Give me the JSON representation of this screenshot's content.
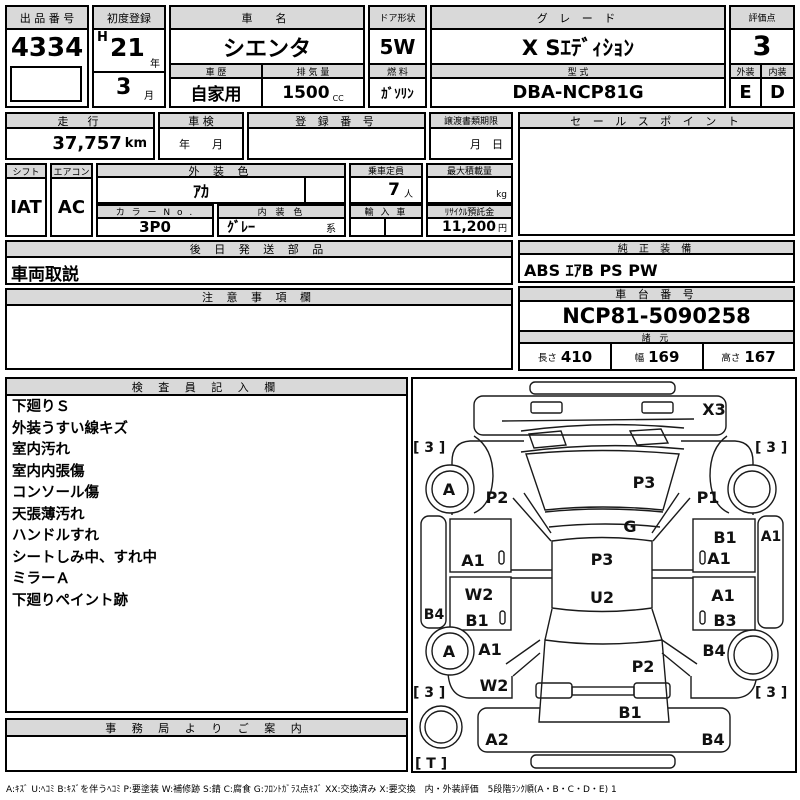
{
  "top": {
    "auction_no": {
      "label": "出 品 番 号",
      "value": "4334"
    },
    "first_reg": {
      "label": "初度登録",
      "era": "H",
      "year": "21",
      "year_unit": "年",
      "month": "3",
      "month_unit": "月"
    },
    "car_name": {
      "label": "車　名",
      "value": "シエンタ"
    },
    "history": {
      "label": "車 歴",
      "value": "自家用"
    },
    "displacement": {
      "label": "排 気 量",
      "value": "1500",
      "unit": "CC"
    },
    "door": {
      "label": "ドア形状",
      "value": "5W"
    },
    "fuel": {
      "label": "燃 料",
      "value": "ｶﾞｿﾘﾝ"
    },
    "grade": {
      "label": "グ レ ー ド",
      "value": "X Sｴﾃﾞｨｼｮﾝ"
    },
    "model": {
      "label": "型 式",
      "value": "DBA-NCP81G"
    },
    "score": {
      "label": "評価点",
      "value": "3"
    },
    "exterior": {
      "label": "外装",
      "value": "E"
    },
    "interior": {
      "label": "内装",
      "value": "D"
    }
  },
  "info": {
    "mileage": {
      "label": "走　行",
      "value": "37,757",
      "unit": "km"
    },
    "shaken": {
      "label": "車 検",
      "value": "年　　月"
    },
    "regno": {
      "label": "登 録 番 号",
      "value": ""
    },
    "deadline": {
      "label": "譲渡書類期限",
      "value": "月　日"
    },
    "shift": {
      "label": "シフト",
      "value": "IAT"
    },
    "aircon": {
      "label": "エアコン",
      "value": "AC"
    },
    "ext_color": {
      "label": "外 装 色",
      "value": "ｱｶ"
    },
    "capacity": {
      "label": "乗車定員",
      "value": "7",
      "unit": "人"
    },
    "max_load": {
      "label": "最大積載量",
      "value": "",
      "unit": "kg"
    },
    "color_no": {
      "label": "カ ラ ー N o .",
      "value": "3P0"
    },
    "int_color": {
      "label": "内 装 色",
      "value": "ｸﾞﾚｰ",
      "suffix": "系"
    },
    "import_car": {
      "label": "輸 入 車",
      "value": ""
    },
    "recycle": {
      "label": "ﾘｻｲｸﾙ預託金",
      "value": "11,200",
      "unit": "円"
    }
  },
  "sales": {
    "label": "セ ー ル ス ポ イ ン ト",
    "value": ""
  },
  "later": {
    "label": "後 日 発 送 部 品",
    "value": "車両取説"
  },
  "caution": {
    "label": "注 意 事 項 欄",
    "value": ""
  },
  "oem": {
    "label": "純 正 装 備",
    "value": "ABS ｴｱB PS PW"
  },
  "chassis": {
    "label": "車 台 番 号",
    "value": "NCP81-5090258"
  },
  "dims": {
    "label": "諸 元",
    "length_label": "長さ",
    "length": "410",
    "width_label": "幅",
    "width": "169",
    "height_label": "高さ",
    "height": "167"
  },
  "inspector": {
    "label": "検 査 員 記 入 欄",
    "lines": [
      "下廻りＳ",
      "外装うすい線キズ",
      "室内汚れ",
      "室内内張傷",
      "コンソール傷",
      "天張薄汚れ",
      "ハンドルすれ",
      "シートしみ中、すれ中",
      "ミラーＡ",
      "下廻りペイント跡"
    ]
  },
  "office": {
    "label": "事 務 局 よ り ご 案 内",
    "value": ""
  },
  "diagram": {
    "labels": {
      "front_bumper": "X3",
      "front_left_fender": "P2",
      "front_right_fender": "P1",
      "windshield": "P3",
      "glass": "G",
      "roof": "P3",
      "roof_rear": "U2",
      "left_front_door": "A1",
      "left_rear_door_1": "W2",
      "left_rear_door_2": "B1",
      "left_sill": "B4",
      "left_quarter_1": "A1",
      "left_quarter_2": "W2",
      "right_front_door_1": "B1",
      "right_front_door_2": "A1",
      "right_rear_door_1": "A1",
      "right_rear_door_2": "B3",
      "right_sill": "A1",
      "right_quarter": "B4",
      "rear_gate": "P2",
      "rear_gate_lower": "B1",
      "rear_bumper_left": "A2",
      "rear_bumper_right": "B4",
      "wheel_front_left": "A",
      "wheel_rear_left": "A",
      "tire_front_left": "[ 3 ]",
      "tire_front_right": "[ 3 ]",
      "tire_rear_left": "[ 3 ]",
      "tire_rear_right": "[ 3 ]",
      "spare": "[ T ]"
    }
  },
  "footer": {
    "legend": "A:ｷｽﾞ  U:ﾍｺﾐ  B:ｷｽﾞを伴うﾍｺﾐ  P:要塗装  W:補修跡  S:錆  C:腐食  G:ﾌﾛﾝﾄｶﾞﾗｽ点ｷｽﾞ  XX:交換済み  X:要交換　内・外装評価　5段階ﾗﾝｸ順(A・B・C・D・E) 1"
  }
}
